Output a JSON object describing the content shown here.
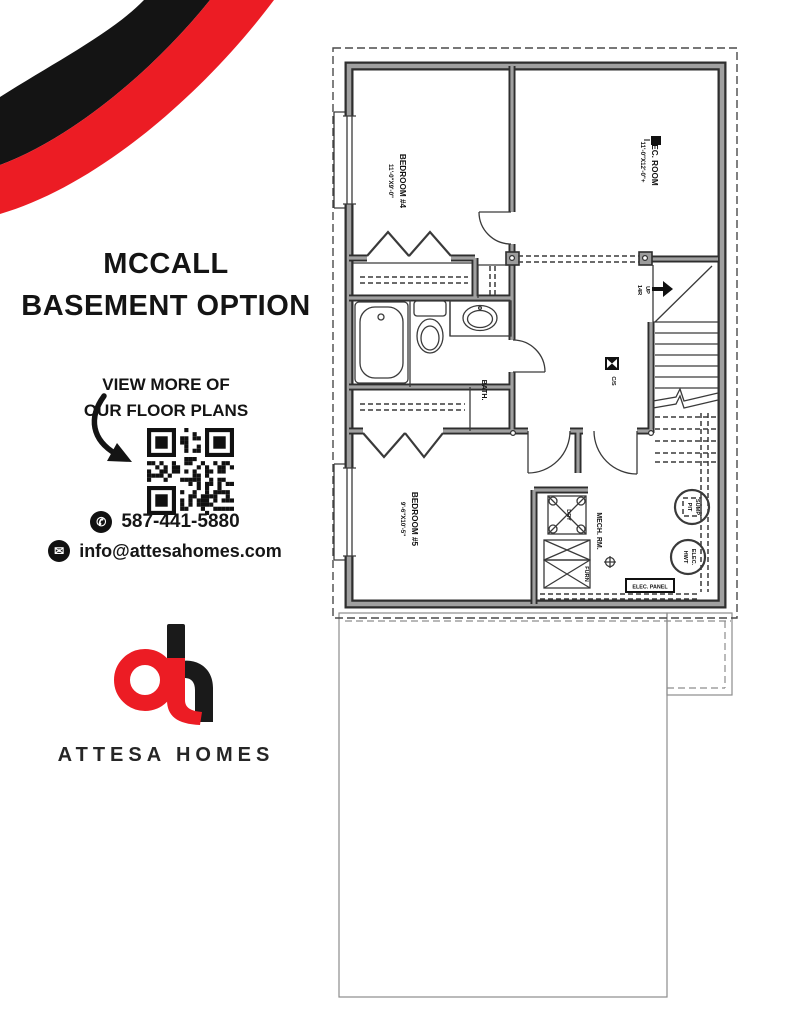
{
  "page": {
    "title_line1": "MCCALL",
    "title_line2": "BASEMENT OPTION"
  },
  "cta": {
    "line1": "VIEW MORE OF",
    "line2": "OUR FLOOR PLANS"
  },
  "contact": {
    "phone": "587-441-5880",
    "email": "info@attesahomes.com"
  },
  "brand": {
    "name": "ATTESA HOMES",
    "red": "#EC1C24",
    "black": "#1A1A1A"
  },
  "plan": {
    "rooms": {
      "bedroom4": {
        "name": "BEDROOM #4",
        "dims": "11'-0\"X9'-0\""
      },
      "rec_room": {
        "name": "REC. ROOM",
        "dims": "11'-0\"X12'-0\"+"
      },
      "bedroom5": {
        "name": "BEDROOM #5",
        "dims": "9'-6\"X10'-5\""
      },
      "bath": {
        "name": "BATH."
      },
      "mech": {
        "name": "MECH. RM."
      }
    },
    "labels": {
      "stairs_up": "UP",
      "stairs_risers": "14R",
      "detector": "C/S",
      "sump_line1": "SUMP",
      "sump_line2": "PIT",
      "hwt_line1": "ELEC.",
      "hwt_line2": "HWT",
      "dryer": "DRY",
      "furnace": "FURN",
      "elec_panel": "ELEC. PANEL"
    }
  }
}
